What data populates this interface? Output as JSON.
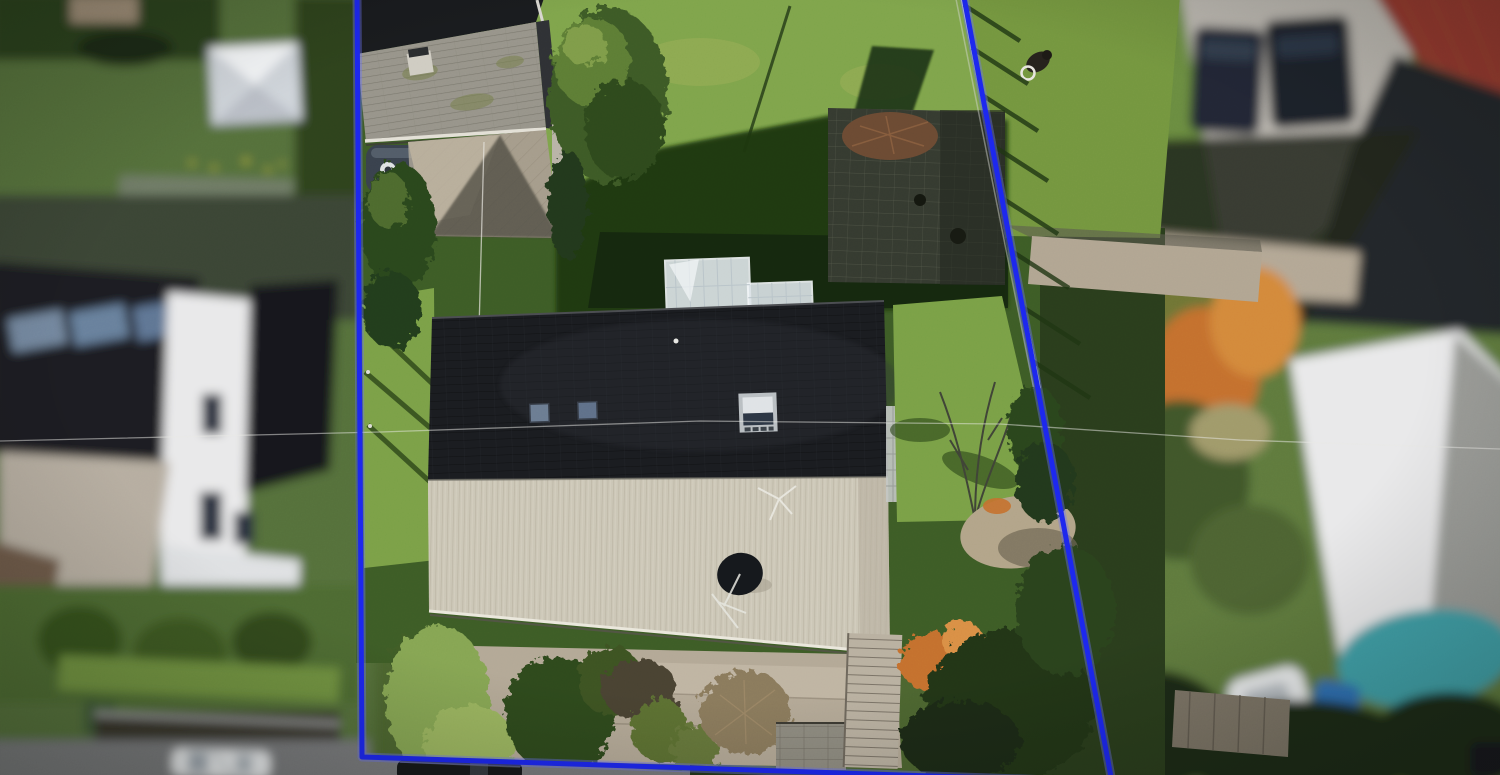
{
  "meta": {
    "type": "aerial-drone-photograph",
    "subject": "residential-property-with-marked-parcel-boundary",
    "width_px": 1500,
    "height_px": 775,
    "focus": "center-parcel-sharp-neighbor-lots-blurred"
  },
  "boundary": {
    "color": "#1c27ee",
    "glow_color": "#6b74f5",
    "stroke_width_px": 5,
    "vertices_px": [
      [
        357,
        -8
      ],
      [
        362,
        757
      ],
      [
        1112,
        782
      ],
      [
        963,
        -8
      ]
    ],
    "shape": "open-top-quadrilateral"
  },
  "palette": {
    "lawn_sunlit": "#7fa44b",
    "lawn_shaded": "#3d5c26",
    "lawn_deep_shadow": "#14260e",
    "roof_dark": "#1a1c20",
    "roof_light": "#cbc6b6",
    "garage_roof_gray": "#97948a",
    "patio_paving": "#353a30",
    "gravel_bed": "#b3a896",
    "road_gray": "#77787a",
    "pool_teal": "#3fa0a8",
    "carport_red": "#93382e",
    "neighbor_white": "#e9e9ea",
    "autumn_orange": "#c4702e",
    "autumn_olive": "#6f7434",
    "hedge_green": "#2f481e",
    "driveway_tan": "#b6ada0",
    "greenhouse_glass": "#dfe7ea"
  },
  "scene": {
    "elements": [
      {
        "name": "parcel-boundary-line",
        "desc": "thick blue surveyed boundary overlay, open at top"
      },
      {
        "name": "main-house",
        "desc": "gable roof, dark shaded north slope with skylights, sunlit corrugated south slope"
      },
      {
        "name": "satellite-dish",
        "desc": "dark dish on light roof slope"
      },
      {
        "name": "roof-window",
        "desc": "opened silver-framed skylight on dark slope"
      },
      {
        "name": "greenhouse",
        "desc": "white glazed conservatory at north facade"
      },
      {
        "name": "garage",
        "desc": "gray tiled roof, top-left of parcel, rain barrel beside wall"
      },
      {
        "name": "back-lawn",
        "desc": "sunlit upper lawn with house and chimney shadows"
      },
      {
        "name": "patio",
        "desc": "dark block paving, upper right of parcel"
      },
      {
        "name": "right-fence",
        "desc": "post fence along east boundary casting shadows"
      },
      {
        "name": "front-garden",
        "desc": "gravel terraced beds, shrubs, retaining wall, garden stairs"
      },
      {
        "name": "street",
        "desc": "road along bottom edge with parked cars"
      },
      {
        "name": "left-neighbor-house",
        "desc": "blurred white gabled house with dark roofs and skylights"
      },
      {
        "name": "right-neighbor-lot",
        "desc": "blurred driveway, vehicles, red carport roof, autumn trees, pool"
      }
    ]
  }
}
